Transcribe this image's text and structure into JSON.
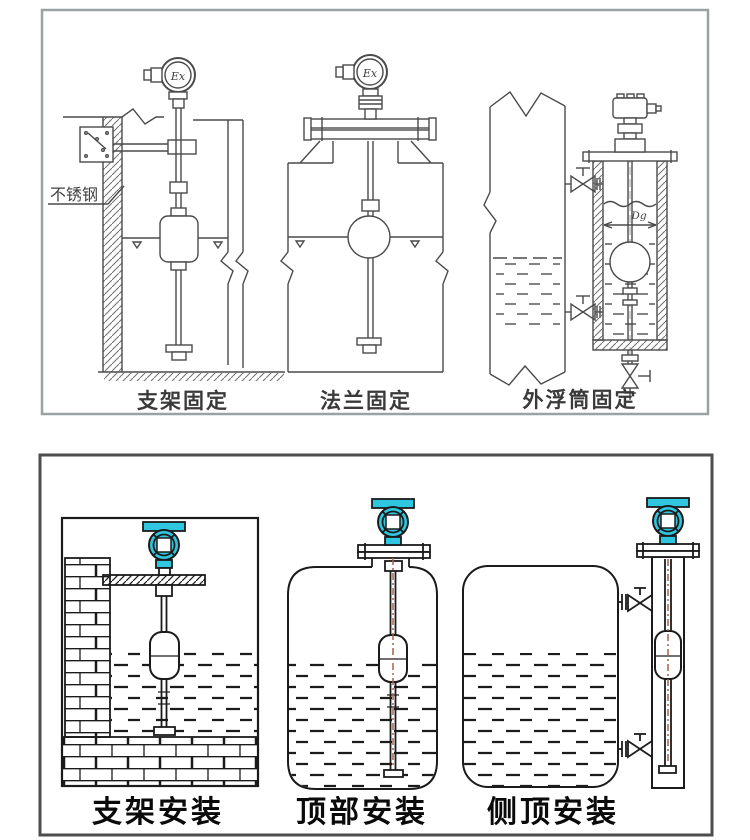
{
  "top_panel": {
    "captions": [
      "支架固定",
      "法兰固定",
      "外浮筒固定"
    ],
    "labels": {
      "stainless_steel": "不锈钢",
      "ex_left": "Ex",
      "ex_middle": "Ex",
      "dg": "Dg"
    }
  },
  "bottom_panel": {
    "captions": [
      "支架安装",
      "顶部安装",
      "侧顶安装"
    ]
  },
  "colors": {
    "accent_teal": "#2fc6e0",
    "line_dark": "#1b1b1b",
    "line_gray": "#4a4a4a",
    "red_centerline": "#a4634a"
  }
}
